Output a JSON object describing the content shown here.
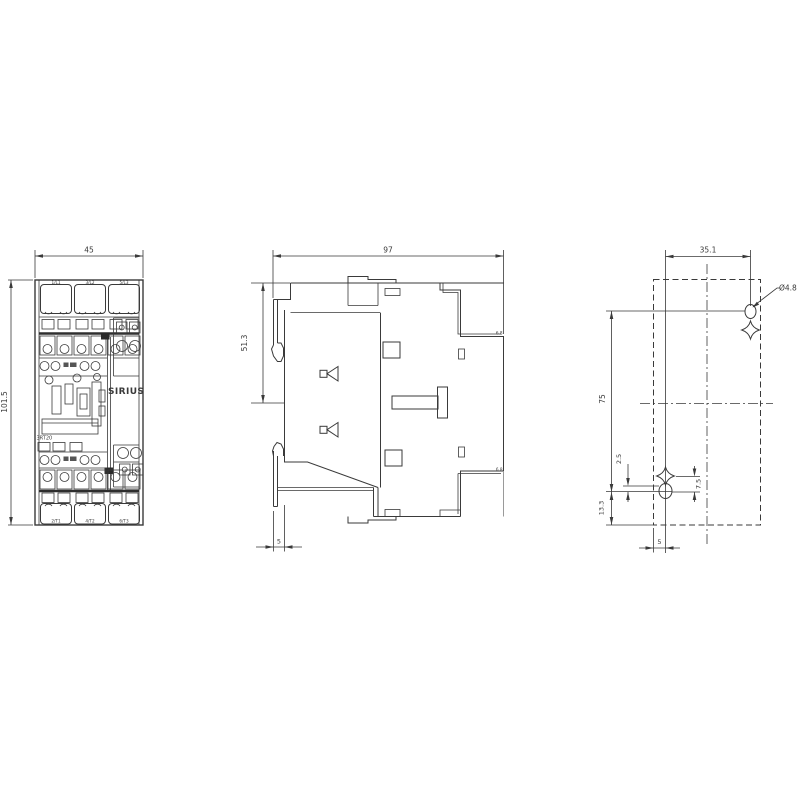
{
  "drawing": {
    "front_view": {
      "width": "45",
      "height": "101.5",
      "brand": "SIRIUS",
      "model": "3RT20",
      "terminals_top": [
        "1/L1",
        "3/L2",
        "5/L3"
      ],
      "terminals_bottom": [
        "2/T1",
        "4/T2",
        "6/T3"
      ]
    },
    "side_view": {
      "width": "97",
      "upper_height": "51.3",
      "rail_clip_depth": "5",
      "rear_top_mark": "6.8",
      "rear_bottom_mark": "6.8"
    },
    "drill_plan": {
      "hole_spacing_horizontal": "35.1",
      "hole_spacing_vertical": "75",
      "hole_diameter": "Ø4.8",
      "slot_offset": "2.5",
      "slot_length": "7.5",
      "bottom_offset": "13.3",
      "left_offset": "5"
    },
    "colors": {
      "line": "#3a3a3a",
      "line_light": "#9a9a9a",
      "background": "#ffffff"
    }
  }
}
